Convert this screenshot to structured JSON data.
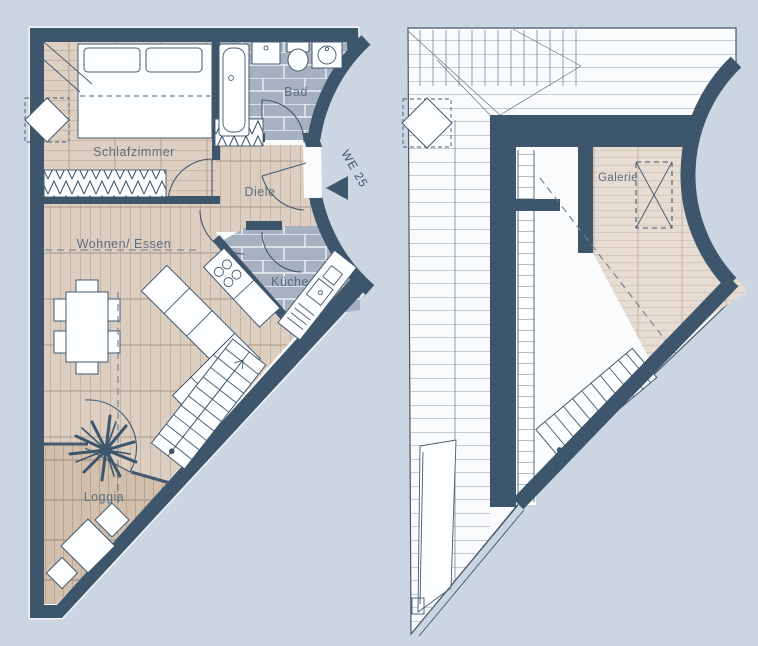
{
  "floorplan": {
    "lower_level": {
      "rooms": {
        "bedroom": "Schlafzimmer",
        "bath": "Bad",
        "hall": "Diele",
        "living_dining": "Wohnen/ Essen",
        "kitchen": "Küche",
        "loggia": "Loggia"
      },
      "entrance_unit": "WE 25"
    },
    "upper_level": {
      "rooms": {
        "gallery": "Galerie"
      }
    },
    "colors": {
      "background": "#ccd5e2",
      "wall": "#3e566c",
      "wood_floor": "#dccfc2",
      "loggia_floor": "#d2c0ad",
      "gallery_floor": "#e6dcd2",
      "tile": "#a6b0c0",
      "label_text": "#5a6e82",
      "paper": "#fafbfd"
    }
  }
}
